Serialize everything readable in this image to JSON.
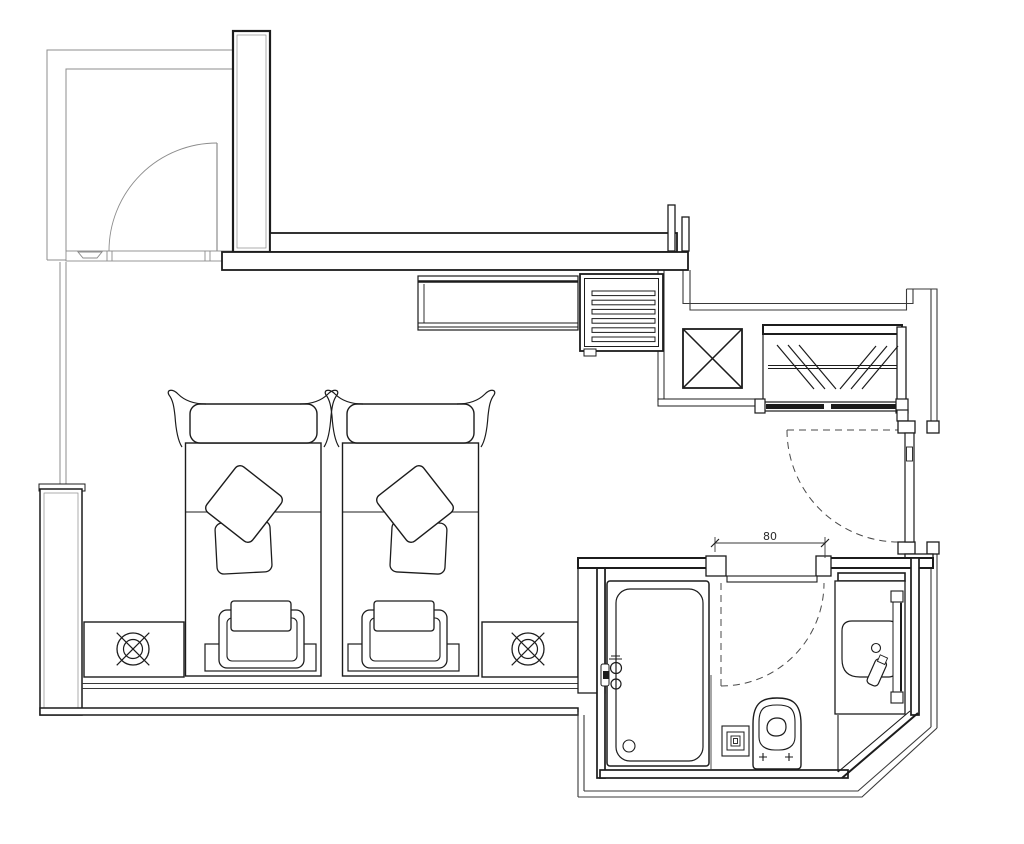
{
  "drawing": {
    "type": "architectural-floor-plan",
    "dimension_label": "80",
    "fixtures": [
      "entry-vestibule-door",
      "twin-bed-left",
      "twin-bed-right",
      "bed-pillow",
      "bed-bench",
      "nightstand-left",
      "nightstand-right",
      "ceiling-lamp-symbol",
      "console-cabinet",
      "vent-grille",
      "elevator-shaft",
      "wardrobe-sliding-doors",
      "room-entry-door",
      "bathroom-door",
      "bathtub",
      "tub-faucet",
      "floor-drain",
      "toilet",
      "vanity-counter",
      "washbasin",
      "mirror",
      "dimension-80"
    ]
  },
  "colors": {
    "background": "#ffffff",
    "wall_line": "#1c1c1c",
    "medium_line": "#3a3a3a",
    "light_line": "#8c8c8c",
    "dash_line": "#4a4a4a"
  }
}
